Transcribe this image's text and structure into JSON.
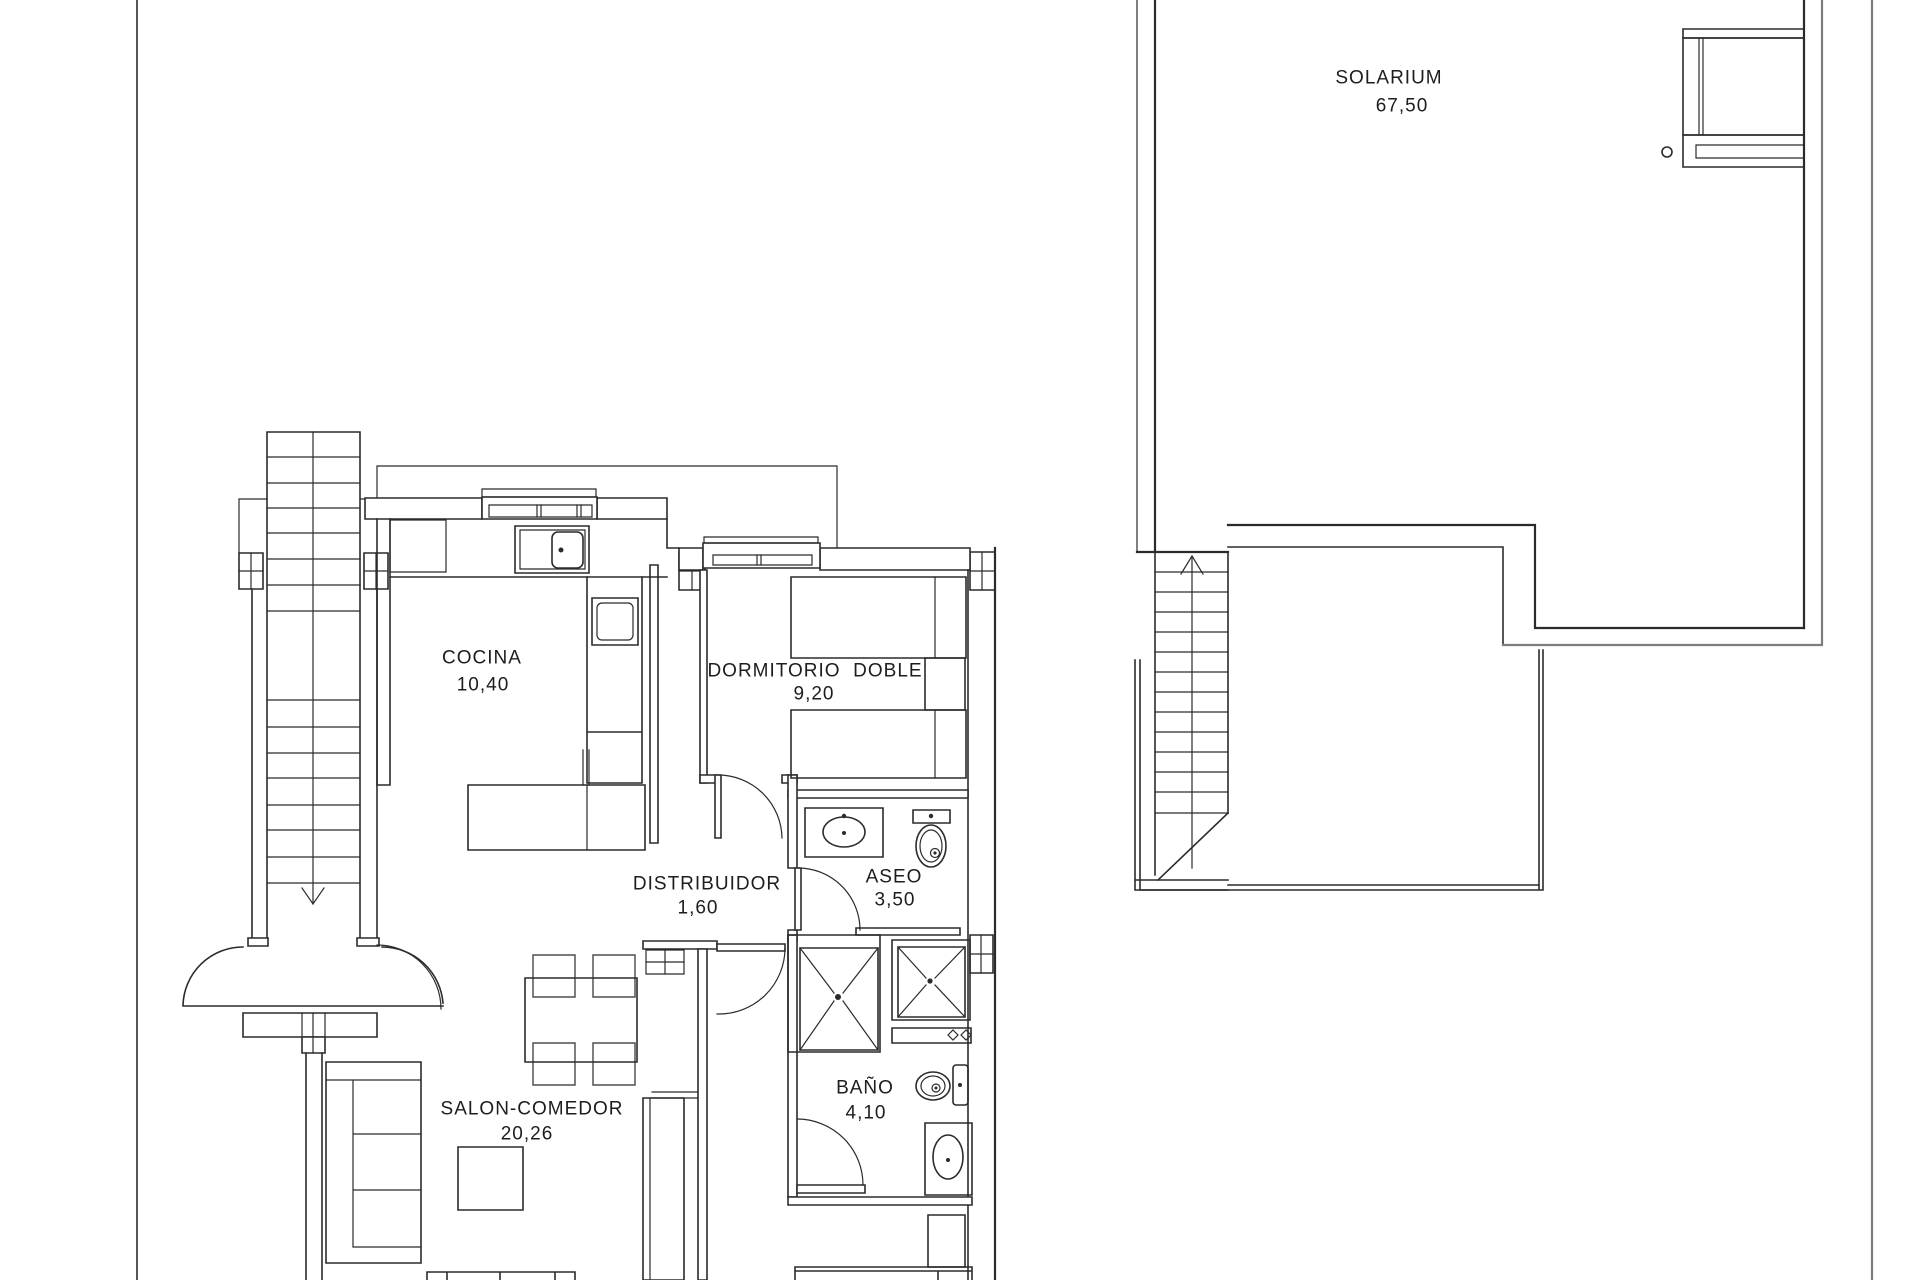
{
  "document_type": "architectural-floor-plan",
  "colors": {
    "line": "#2b2b2b",
    "outer_boundary": "#7d7d7d",
    "background": "#ffffff",
    "label_text": "#1d1d1d"
  },
  "rooms": [
    {
      "id": "cocina",
      "name": "COCINA",
      "area": "10,40"
    },
    {
      "id": "dormitorio",
      "name": "DORMITORIO  DOBLE",
      "area": "9,20"
    },
    {
      "id": "distribuidor",
      "name": "DISTRIBUIDOR",
      "area": "1,60"
    },
    {
      "id": "aseo",
      "name": "ASEO",
      "area": "3,50"
    },
    {
      "id": "salon",
      "name": "SALON-COMEDOR",
      "area": "20,26"
    },
    {
      "id": "bano",
      "name": "BAÑO",
      "area": "4,10"
    },
    {
      "id": "solarium",
      "name": "SOLARIUM",
      "area": "67,50"
    }
  ],
  "icons": {
    "stairs_down_arrow": "v-arrowhead",
    "stairs_up_arrow": "^-arrowhead",
    "sink": "oval-in-rect",
    "toilet": "tank-and-bowl",
    "shower": "crossed-square",
    "kitchen_sink": "rounded-basin-with-tap"
  }
}
